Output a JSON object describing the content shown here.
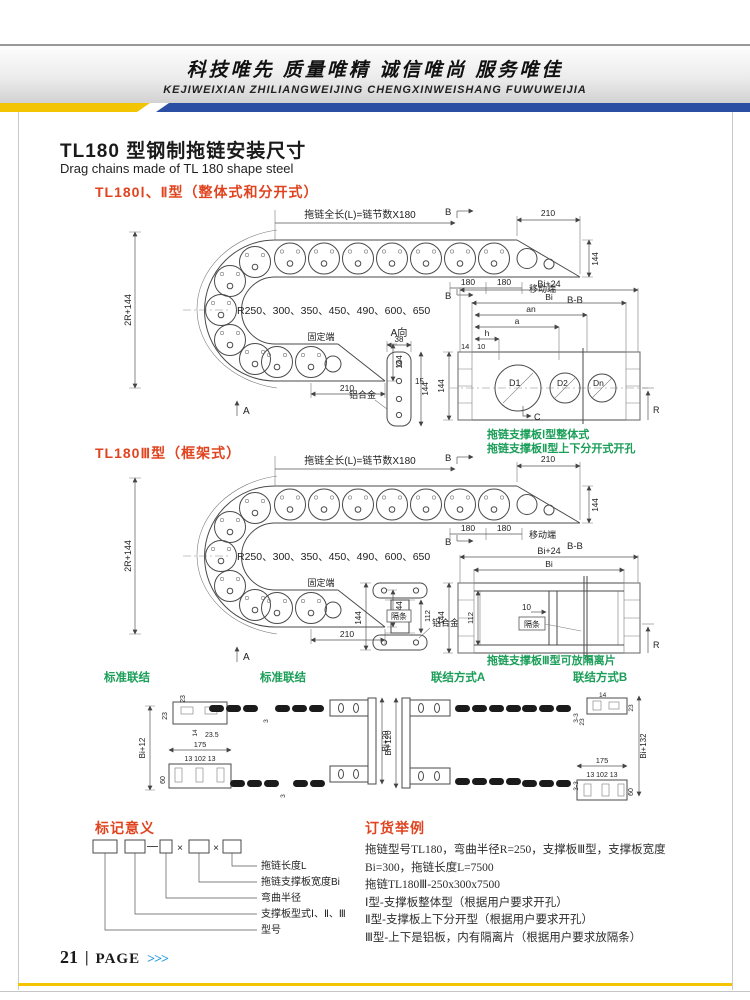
{
  "theme": {
    "red": "#e0431f",
    "green": "#1a9e58",
    "stripe-blue": "#2b4fa2",
    "stripe-yellow": "#f3c402",
    "footer-blue": "#1f97dc"
  },
  "header": {
    "slogan": "科技唯先  质量唯精  诚信唯尚  服务唯佳",
    "romanized": "KEJIWEIXIAN  ZHILIANGWEIJING  CHENGXINWEISHANG  FUWUWEIJIA"
  },
  "page": {
    "title_cn": "TL180 型钢制拖链安装尺寸",
    "title_en": "Drag chains made of TL 180 shape steel"
  },
  "sections": {
    "s1_heading": "TL180Ⅰ、Ⅱ型（整体式和分开式）",
    "s2_heading": "TL180Ⅲ型（框架式）",
    "note1": "拖链支撑板Ⅰ型整体式",
    "note2": "拖链支撑板Ⅱ型上下分开式开孔",
    "note3": "拖链支撑板Ⅲ型可放隔离片",
    "joint_labels": [
      "标准联结",
      "标准联结",
      "联结方式A",
      "联结方式B"
    ]
  },
  "dims": {
    "total_length": "拖链全长(L)=链节数X180",
    "radii": "R250、300、350、450、490、600、650",
    "fixed_end": "固定端",
    "moving_end": "移动端",
    "bb": "B-B",
    "b": "B",
    "a_arrow": "A",
    "view_a": "A向",
    "alloy": "铝合金",
    "spacer_bar": "隔条",
    "d210": "210",
    "d144": "144",
    "d180": "180",
    "d2r": "2R+144",
    "d38": "38",
    "d15": "15",
    "bi24": "Bi+24",
    "bi": "Bi",
    "an": "an",
    "a": "a",
    "h": "h",
    "d14": "14",
    "d10": "10",
    "D1": "D1",
    "D2": "D2",
    "Dn": "Dn",
    "C": "C",
    "R": "R",
    "d112": "112",
    "bi12": "Bi+12",
    "bi20": "Bi+20",
    "bi120": "Bi+120",
    "bi132": "Bi+132",
    "d23": "23",
    "d235": "23.5",
    "d175": "175",
    "d13": "13 102 13",
    "d60": "60",
    "d3": "3",
    "d33": "3-3"
  },
  "marking": {
    "heading": "标记意义",
    "x": "×",
    "labels": [
      "拖链长度L",
      "拖链支撑板宽度Bi",
      "弯曲半径",
      "支撑板型式Ⅰ、Ⅱ、Ⅲ",
      "型号"
    ]
  },
  "order": {
    "heading": "订货举例",
    "lines": [
      "拖链型号TL180，弯曲半径R=250，支撑板Ⅲ型，支撑板宽度",
      "Bi=300，拖链长度L=7500",
      "拖链TL180Ⅲ-250x300x7500",
      "Ⅰ型-支撑板整体型（根据用户要求开孔）",
      "Ⅱ型-支撑板上下分开型（根据用户要求开孔）",
      "Ⅲ型-上下是铝板，内有隔离片（根据用户要求放隔条）"
    ]
  },
  "footer": {
    "page_no": "21",
    "divider": "|",
    "label": "PAGE",
    "arrows": ">>>"
  }
}
